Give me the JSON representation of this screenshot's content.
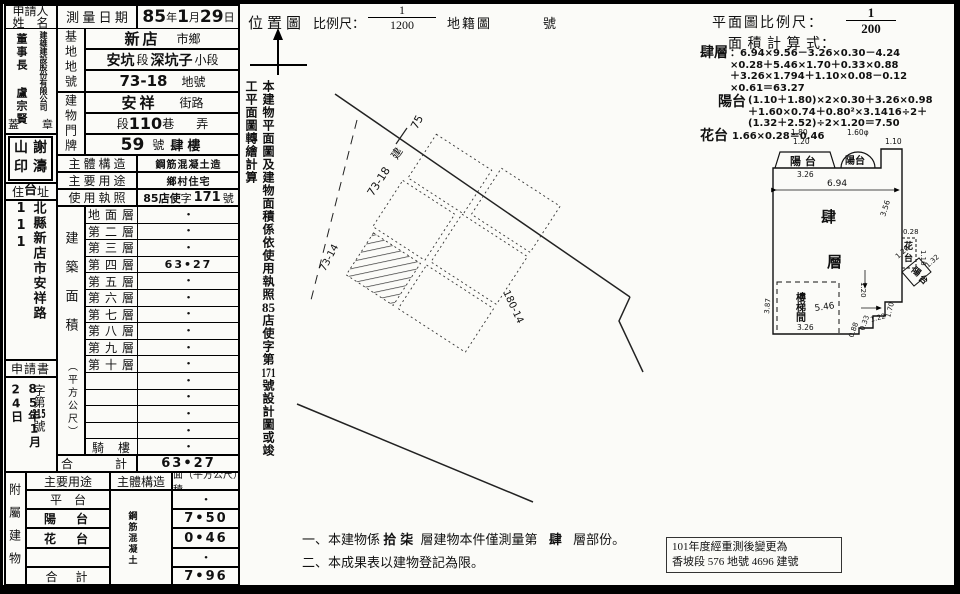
{
  "left": {
    "applicant_label_1": "申請人",
    "applicant_label_2": "姓　名",
    "applicant_company": "建雄建設股份有限公司",
    "applicant_person": "董事長 盧宗賢",
    "seal_row_left": "蓋",
    "seal_row_right": "章",
    "seal_grid": [
      "山",
      "謝",
      "印",
      "濤"
    ],
    "address_label_pre": "住",
    "address_overlay": "台",
    "address_label_post": "址",
    "address_value": "北縣新店市安祥路111",
    "application_label": "申請書",
    "receipt_date": "85年1月24日",
    "receipt_no_prefix": "字第",
    "receipt_no": "215",
    "receipt_no_suffix": "號",
    "survey_label": "測 量 日 期",
    "survey_y": "85",
    "survey_yu": "年",
    "survey_m": "1",
    "survey_mu": "月",
    "survey_d": "29",
    "survey_du": "日",
    "site_label": "基地地號",
    "site_city_hw": "新店",
    "site_city_p": "市鄉",
    "site_sec_hw1": "安坑",
    "site_sec_p1": "段",
    "site_sec_hw2": "深坑子",
    "site_sec_p2": "小段",
    "site_lot_hw": "73-18",
    "site_lot_p": "地號",
    "bld_label": "建物門牌",
    "bld_street_hw": "安祥",
    "bld_street_p": "街路",
    "bld_sec_p1": "段",
    "bld_sec_hw": "110",
    "bld_sec_p2": "巷",
    "bld_sec_p3": "弄",
    "bld_no_hw": "59",
    "bld_no_p": "號",
    "bld_no_floor": "肆樓",
    "structure_label": "主 體 構 造",
    "structure_value": "鋼筋混凝土造",
    "usage_label": "主 要 用 途",
    "usage_value": "鄉村住宅",
    "license_label": "使 用 執 照",
    "license_hw1": "85店使",
    "license_p1": "字",
    "license_hw2": "171",
    "license_p2": "號",
    "area_side_1": "建築面積",
    "area_side_2": "（平方公尺）",
    "floors": [
      {
        "label": "地 面 層",
        "value": "•"
      },
      {
        "label": "第 二 層",
        "value": "•"
      },
      {
        "label": "第 三 層",
        "value": "•"
      },
      {
        "label": "第 四 層",
        "value": "63•27"
      },
      {
        "label": "第 五 層",
        "value": "•"
      },
      {
        "label": "第 六 層",
        "value": "•"
      },
      {
        "label": "第 七 層",
        "value": "•"
      },
      {
        "label": "第 八 層",
        "value": "•"
      },
      {
        "label": "第 九 層",
        "value": "•"
      },
      {
        "label": "第 十 層",
        "value": "•"
      },
      {
        "label": "",
        "value": "•"
      },
      {
        "label": "",
        "value": "•"
      },
      {
        "label": "",
        "value": "•"
      },
      {
        "label": "",
        "value": "•"
      },
      {
        "label": "騎　樓",
        "value": "•"
      }
    ],
    "total_label": "合　　計",
    "total_value": "63•27",
    "annex_side": "附屬建物",
    "annex_h1": "主要用途",
    "annex_h2": "主體構造",
    "annex_h3": "面（平方公尺）積",
    "annex_structure": "鋼筋混凝土",
    "annex_rows": [
      {
        "label": "平　台",
        "value": "•"
      },
      {
        "label": "陽　台",
        "value": "7•50"
      },
      {
        "label": "花　台",
        "value": "0•46"
      },
      {
        "label": "",
        "value": "•"
      },
      {
        "label": "合　計",
        "value": "7•96"
      }
    ]
  },
  "middle": {
    "title": "位置圖",
    "scale_label": "比例尺：",
    "scale_num": "1",
    "scale_den": "1200",
    "map_label": "地籍圖",
    "no_label": "號",
    "note_v1": "本建物平面圖及建物面積係依使用執照",
    "note_v2": "85",
    "note_v3": "店使字第",
    "note_v4": "171",
    "note_v5": "號設計圖或竣工平面圖轉繪計算",
    "map_labels": [
      "75",
      "73-18",
      "建",
      "73-14",
      "180-14"
    ],
    "note1_prefix": "一、",
    "note1_a": "本建物係",
    "note1_hw1": "拾柒",
    "note1_b": "層建物本件僅測量第",
    "note1_hw2": "肆",
    "note1_c": "層部份。",
    "note2_prefix": "二、",
    "note2": "本成果表以建物登記為限。"
  },
  "right": {
    "scale_label": "平面圖比例尺：",
    "scale_num": "1",
    "scale_den": "200",
    "calc_label": "面 積 計 算 式：",
    "f1_name": "肆層",
    "f1_l1": "：6.94×9.56－3.26×0.30－4.24",
    "f1_l2": "×0.28＋5.46×1.70＋0.33×0.88",
    "f1_l3": "＋3.26×1.794＋1.10×0.08－0.12",
    "f1_l4": "×0.61＝63.27",
    "f2_name": "陽台",
    "f2_l1": "(1.10＋1.80)×2×0.30＋3.26×0.98",
    "f2_l2": "＋1.60×0.74＋0.80²×3.1416÷2＋",
    "f2_l3": "(1.32＋2.52)÷2×1.20＝7.50",
    "f3_name": "花台",
    "f3_l1": "1.66×0.28＝0.46",
    "remark1": "101年度經重測後變更為",
    "remark2": "香坡段 576 地號 4696 建號",
    "plan": {
      "label_balcony_left": "陽 台",
      "label_balcony_top": "陽台",
      "label_flower_1": "花",
      "label_flower_2": "台",
      "label_balcony_right_1": "陽",
      "label_balcony_right_2": "台",
      "label_main_1": "肆",
      "label_main_2": "層",
      "label_stairs": "樓梯間",
      "dims": [
        "1.80",
        "1.20",
        "3.26",
        "1.60φ",
        "1.10",
        "6.94",
        "3.56",
        "0.28",
        "1.16",
        "1.20",
        "1.32",
        "1.20",
        "1.70",
        "1.22",
        "0.33",
        "0.88",
        "5.46",
        "3.26",
        "3.87"
      ]
    }
  }
}
